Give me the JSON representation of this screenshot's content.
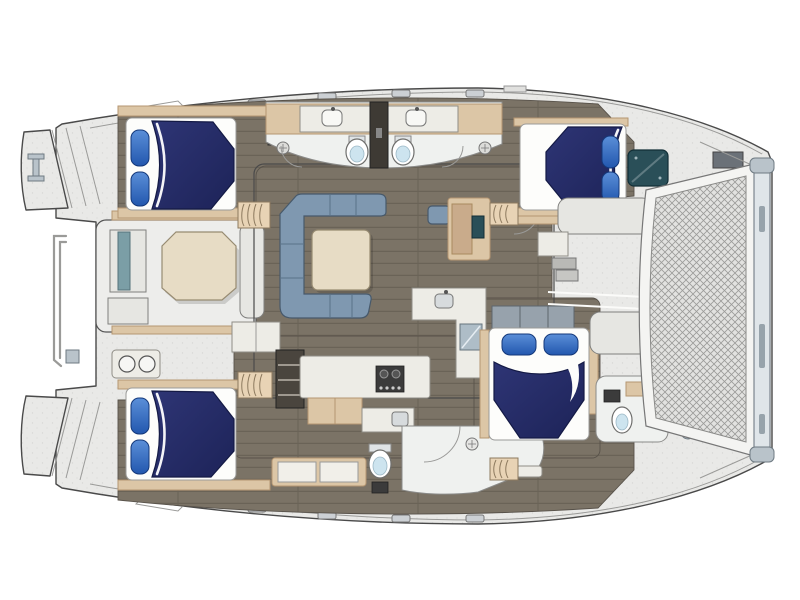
{
  "scene": {
    "type": "floor-plan",
    "subject": "catamaran yacht interior layout, overhead deck plan",
    "bow_direction": "right",
    "stern_direction": "left",
    "labels": {
      "boat": "catamaran deck plan",
      "cockpit": "aft cockpit",
      "saloon": "saloon",
      "galley": "galley",
      "port_aft_cabin": "port aft cabin",
      "port_heads": "port heads",
      "port_forward_cabin": "port forward cabin",
      "starboard_aft_cabin": "starboard aft cabin",
      "starboard_aft_bathroom": "starboard aft bathroom",
      "starboard_forward_cabin": "starboard forward cabin",
      "starboard_forward_head": "starboard forward head",
      "foredeck": "forward cockpit",
      "trampoline": "bow trampoline",
      "stern": "stern platforms"
    },
    "rooms": [
      {
        "id": "aft-cockpit",
        "features": [
          "octagonal-dining-table",
          "helm-seat",
          "bench-seating",
          "two-burner-grill",
          "davit-rail"
        ]
      },
      {
        "id": "saloon",
        "features": [
          "l-shaped-sofa",
          "coffee-table",
          "nav-station",
          "island-counter-with-sink",
          "appliance"
        ]
      },
      {
        "id": "galley",
        "features": [
          "two-burner-stove",
          "sink",
          "wood-drawers",
          "storage-shelves",
          "cabinets"
        ]
      },
      {
        "id": "port-aft-cabin",
        "features": [
          "double-berth",
          "two-pillows",
          "companionway-steps"
        ]
      },
      {
        "id": "port-heads",
        "features": [
          "two-toilets",
          "two-sink-counters",
          "two-shower-drains",
          "dark-locker"
        ]
      },
      {
        "id": "port-forward-cabin",
        "features": [
          "double-berth",
          "two-pillows",
          "companionway-steps"
        ]
      },
      {
        "id": "starboard-aft-cabin",
        "features": [
          "double-berth",
          "two-pillows",
          "companionway-steps"
        ]
      },
      {
        "id": "starboard-aft-bathroom",
        "features": [
          "toilet",
          "shower-with-door",
          "drain",
          "bench"
        ]
      },
      {
        "id": "starboard-forward-cabin",
        "features": [
          "double-berth",
          "two-pillows",
          "head-bench",
          "companionway-steps"
        ]
      },
      {
        "id": "starboard-forward-head",
        "features": [
          "toilet",
          "vanity-shelf"
        ]
      },
      {
        "id": "foredeck",
        "features": [
          "port-bench",
          "starboard-bench",
          "steps",
          "anchor-locker-hatch",
          "windlass",
          "walkway"
        ]
      },
      {
        "id": "bow",
        "features": [
          "trampoline-net",
          "forward-crossbeam",
          "beam-fittings"
        ]
      },
      {
        "id": "stern",
        "features": [
          "stepped-transoms",
          "boarding-cleat",
          "davit-rail-fitting"
        ]
      }
    ],
    "counts": {
      "cabins": 4,
      "double_berths": 4,
      "toilets": 4,
      "companionway_steps": 4,
      "deck_hatches": 8
    }
  },
  "colors": {
    "background": "#ffffff",
    "outline": "#4a4a4a",
    "deck": "#e9e9e7",
    "floor": "#7b7366",
    "wood": "#dcc6a6",
    "wood_dark": "#b59671",
    "bed_navy": "#242b66",
    "pillow_blue": "#2a64c2",
    "linen": "#fdfdfb",
    "sofa": "#7f98b0",
    "table": "#e7dcc5",
    "counter": "#edece6",
    "appliance_dark": "#3b3b3b",
    "steel": "#b9c3ca",
    "hatch_teal": "#2a4f58",
    "cushion_teal": "#7b9ea6",
    "toilet_blue": "#cde4ef",
    "mesh_line": "#8f8f8d"
  }
}
